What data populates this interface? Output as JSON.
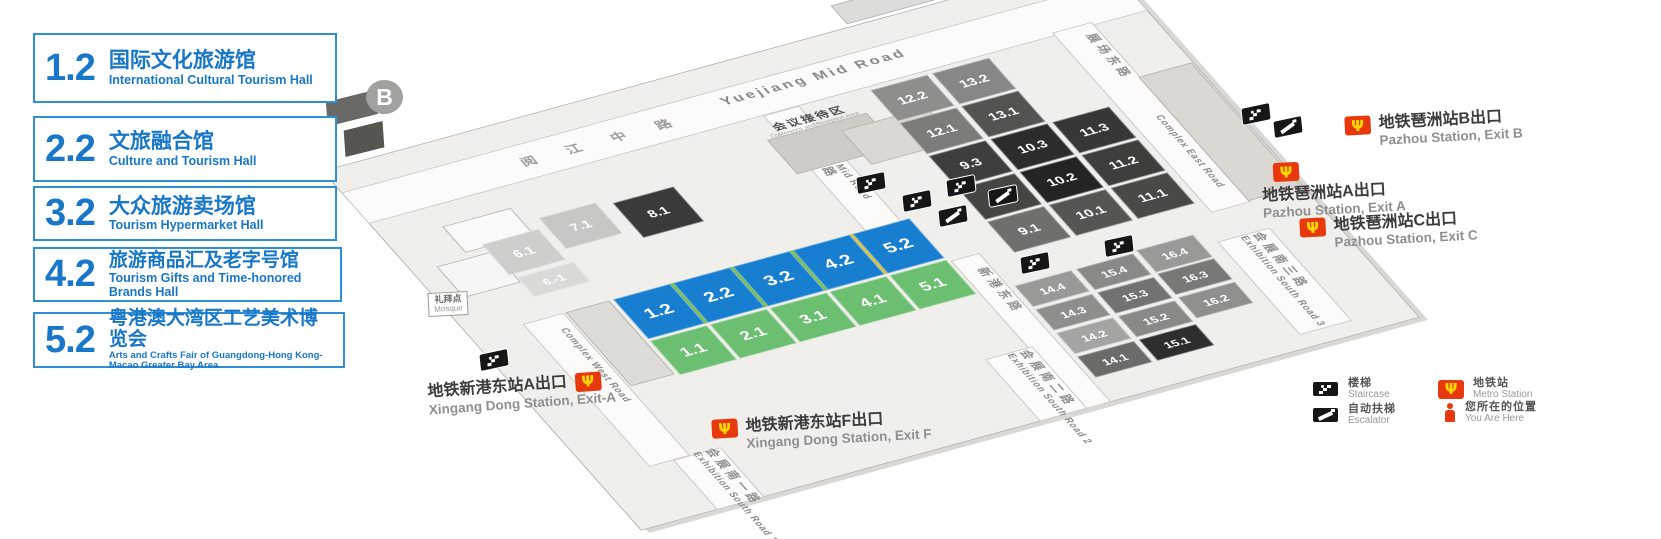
{
  "legend_panels": [
    {
      "code": "1.2",
      "title_zh": "国际文化旅游馆",
      "title_en": "International Cultural Tourism Hall"
    },
    {
      "code": "2.2",
      "title_zh": "文旅融合馆",
      "title_en": "Culture and Tourism Hall"
    },
    {
      "code": "3.2",
      "title_zh": "大众旅游卖场馆",
      "title_en": "Tourism Hypermarket Hall"
    },
    {
      "code": "4.2",
      "title_zh": "旅游商品汇及老字号馆",
      "title_en": "Tourism Gifts and Time-honored Brands Hall"
    },
    {
      "code": "5.2",
      "title_zh": "粤港澳大湾区工艺美术博览会",
      "title_en": "Arts and Crafts Fair of Guangdong-Hong Kong-Macao Greater Bay Area"
    }
  ],
  "map": {
    "area_marker": "B",
    "roads": {
      "yuejiang_en": "Yuejiang Mid Road",
      "yuejiang_zh": "阅 江 中 路",
      "complex_mid_en": "Complex Mid Road",
      "complex_mid_zh": "展场中路",
      "complex_east_en": "Complex East Road",
      "complex_east_zh": "展场东路",
      "complex_west_en": "Complex West Road",
      "xingang_zh": "新港东路",
      "south1_zh": "会展南一路",
      "south1_en": "Exhibition South Road 1",
      "south2_zh": "会展南二路",
      "south2_en": "Exhibition South Road 2",
      "south3_zh": "会展南三路",
      "south3_en": "Exhibition South Road 3"
    },
    "conference": {
      "zh": "会议接待区",
      "en": "Conference and Reception Area"
    },
    "mosque": {
      "zh": "礼拜点",
      "en": "Mosque"
    },
    "highlight_colors": {
      "blue": "#187fd0",
      "green": "#6cbe71",
      "divider_green": "#7ec24a",
      "divider_yellow": "#e2c53a"
    },
    "halls": [
      {
        "label": "1.2",
        "style": {
          "left": "150px",
          "top": "270px",
          "width": "60px",
          "height": "64px",
          "background": "#187fd0",
          "fontSize": "20px"
        }
      },
      {
        "label": "2.2",
        "style": {
          "left": "213px",
          "top": "270px",
          "width": "60px",
          "height": "64px",
          "background": "#187fd0",
          "fontSize": "20px"
        }
      },
      {
        "label": "3.2",
        "style": {
          "left": "276px",
          "top": "270px",
          "width": "60px",
          "height": "64px",
          "background": "#187fd0",
          "fontSize": "20px"
        }
      },
      {
        "label": "4.2",
        "style": {
          "left": "339px",
          "top": "270px",
          "width": "60px",
          "height": "64px",
          "background": "#187fd0",
          "fontSize": "20px"
        }
      },
      {
        "label": "5.2",
        "style": {
          "left": "402px",
          "top": "270px",
          "width": "60px",
          "height": "64px",
          "background": "#187fd0",
          "fontSize": "20px"
        }
      },
      {
        "label": "1.1",
        "style": {
          "left": "150px",
          "top": "337px",
          "width": "60px",
          "height": "55px",
          "background": "#6cbe71",
          "fontSize": "18px"
        }
      },
      {
        "label": "2.1",
        "style": {
          "left": "213px",
          "top": "337px",
          "width": "60px",
          "height": "55px",
          "background": "#6cbe71",
          "fontSize": "18px"
        }
      },
      {
        "label": "3.1",
        "style": {
          "left": "276px",
          "top": "337px",
          "width": "60px",
          "height": "55px",
          "background": "#6cbe71",
          "fontSize": "18px"
        }
      },
      {
        "label": "4.1",
        "style": {
          "left": "339px",
          "top": "337px",
          "width": "60px",
          "height": "55px",
          "background": "#6cbe71",
          "fontSize": "18px"
        }
      },
      {
        "label": "5.1",
        "style": {
          "left": "402px",
          "top": "337px",
          "width": "60px",
          "height": "55px",
          "background": "#6cbe71",
          "fontSize": "18px"
        }
      },
      {
        "label": "12.2",
        "style": {
          "left": "525px",
          "top": "90px",
          "width": "60px",
          "height": "50px",
          "background": "#908e8b"
        }
      },
      {
        "label": "13.2",
        "style": {
          "left": "590px",
          "top": "90px",
          "width": "60px",
          "height": "50px",
          "background": "#898785"
        }
      },
      {
        "label": "12.1",
        "style": {
          "left": "525px",
          "top": "143px",
          "width": "60px",
          "height": "50px",
          "background": "#7e7c79"
        }
      },
      {
        "label": "13.1",
        "style": {
          "left": "590px",
          "top": "143px",
          "width": "60px",
          "height": "50px",
          "background": "#555350"
        }
      },
      {
        "label": "9.3",
        "style": {
          "left": "525px",
          "top": "196px",
          "width": "60px",
          "height": "50px",
          "background": "#403e3c"
        }
      },
      {
        "label": "10.3",
        "style": {
          "left": "590px",
          "top": "196px",
          "width": "60px",
          "height": "50px",
          "background": "#2e2c2a"
        }
      },
      {
        "label": "11.3",
        "style": {
          "left": "655px",
          "top": "196px",
          "width": "60px",
          "height": "50px",
          "background": "#393735"
        }
      },
      {
        "label": "9.2",
        "style": {
          "left": "525px",
          "top": "249px",
          "width": "60px",
          "height": "50px",
          "background": "#474542"
        }
      },
      {
        "label": "10.2",
        "style": {
          "left": "590px",
          "top": "249px",
          "width": "60px",
          "height": "50px",
          "background": "#262422"
        }
      },
      {
        "label": "11.2",
        "style": {
          "left": "655px",
          "top": "249px",
          "width": "60px",
          "height": "50px",
          "background": "#403e3b"
        }
      },
      {
        "label": "9.1",
        "style": {
          "left": "525px",
          "top": "302px",
          "width": "60px",
          "height": "50px",
          "background": "#716f6c"
        }
      },
      {
        "label": "10.1",
        "style": {
          "left": "590px",
          "top": "302px",
          "width": "60px",
          "height": "50px",
          "background": "#575552"
        }
      },
      {
        "label": "11.1",
        "style": {
          "left": "655px",
          "top": "302px",
          "width": "60px",
          "height": "50px",
          "background": "#4b4946"
        }
      },
      {
        "label": "6.1",
        "style": {
          "left": "80px",
          "top": "152px",
          "width": "60px",
          "height": "50px",
          "background": "#d0cecb"
        }
      },
      {
        "label": "7.1",
        "style": {
          "left": "148px",
          "top": "138px",
          "width": "60px",
          "height": "50px",
          "background": "#c9c7c4"
        }
      },
      {
        "label": "8.1",
        "style": {
          "left": "222px",
          "top": "145px",
          "width": "64px",
          "height": "56px",
          "background": "#3b3a38"
        }
      },
      {
        "label": "6.-1",
        "style": {
          "left": "85px",
          "top": "207px",
          "width": "60px",
          "height": "32px",
          "background": "#dcdad7",
          "fontSize": "13px"
        }
      },
      {
        "label": "14.4",
        "style": {
          "left": "500px",
          "top": "395px",
          "width": "60px",
          "height": "34px",
          "background": "#9b9996",
          "fontSize": "13px"
        }
      },
      {
        "label": "15.4",
        "style": {
          "left": "565px",
          "top": "395px",
          "width": "60px",
          "height": "34px",
          "background": "#8b8986",
          "fontSize": "13px"
        }
      },
      {
        "label": "16.4",
        "style": {
          "left": "630px",
          "top": "392px",
          "width": "60px",
          "height": "36px",
          "background": "#9b9996",
          "fontSize": "13px"
        }
      },
      {
        "label": "14.3",
        "style": {
          "left": "500px",
          "top": "433px",
          "width": "60px",
          "height": "34px",
          "background": "#908e8b",
          "fontSize": "13px"
        }
      },
      {
        "label": "15.3",
        "style": {
          "left": "565px",
          "top": "433px",
          "width": "60px",
          "height": "34px",
          "background": "#747270",
          "fontSize": "13px"
        }
      },
      {
        "label": "16.3",
        "style": {
          "left": "630px",
          "top": "430px",
          "width": "60px",
          "height": "34px",
          "background": "#7a7875",
          "fontSize": "13px"
        }
      },
      {
        "label": "14.2",
        "style": {
          "left": "500px",
          "top": "471px",
          "width": "60px",
          "height": "34px",
          "background": "#a6a4a1",
          "fontSize": "13px"
        }
      },
      {
        "label": "15.2",
        "style": {
          "left": "565px",
          "top": "471px",
          "width": "60px",
          "height": "34px",
          "background": "#8b8986",
          "fontSize": "13px"
        }
      },
      {
        "label": "16.2",
        "style": {
          "left": "630px",
          "top": "468px",
          "width": "60px",
          "height": "34px",
          "background": "#918f8c",
          "fontSize": "13px"
        }
      },
      {
        "label": "14.1",
        "style": {
          "left": "500px",
          "top": "509px",
          "width": "60px",
          "height": "34px",
          "background": "#6d6b68",
          "fontSize": "13px"
        }
      },
      {
        "label": "15.1",
        "style": {
          "left": "565px",
          "top": "509px",
          "width": "60px",
          "height": "34px",
          "background": "#2f2e2c",
          "fontSize": "13px"
        }
      }
    ],
    "badges": [
      {
        "type": "staircase",
        "name": "staircase-icon",
        "style": {
          "left": "856px",
          "top": "174px"
        }
      },
      {
        "type": "staircase",
        "name": "staircase-icon",
        "style": {
          "left": "902px",
          "top": "192px"
        }
      },
      {
        "type": "staircase",
        "name": "staircase-icon",
        "style": {
          "left": "946px",
          "top": "177px"
        }
      },
      {
        "type": "staircase",
        "name": "staircase-icon",
        "style": {
          "left": "1020px",
          "top": "254px"
        }
      },
      {
        "type": "staircase",
        "name": "staircase-icon",
        "style": {
          "left": "1104px",
          "top": "237px"
        }
      },
      {
        "type": "staircase",
        "name": "staircase-icon",
        "style": {
          "left": "1241px",
          "top": "105px"
        }
      },
      {
        "type": "staircase",
        "name": "staircase-icon",
        "style": {
          "left": "479px",
          "top": "351px"
        }
      },
      {
        "type": "escalator",
        "name": "escalator-icon",
        "style": {
          "left": "988px",
          "top": "187px"
        }
      },
      {
        "type": "escalator",
        "name": "escalator-icon",
        "style": {
          "left": "938px",
          "top": "207px"
        }
      },
      {
        "type": "escalator",
        "name": "escalator-icon",
        "style": {
          "left": "1273px",
          "top": "118px"
        }
      }
    ]
  },
  "stations": {
    "pazhou_b": {
      "zh": "地铁琶洲站B出口",
      "en": "Pazhou Station, Exit B"
    },
    "pazhou_a": {
      "zh": "地铁琶洲站A出口",
      "en": "Pazhou Station, Exit A"
    },
    "pazhou_c": {
      "zh": "地铁琶洲站C出口",
      "en": "Pazhou Station, Exit C"
    },
    "xingang_a": {
      "zh": "地铁新港东站A出口",
      "en": "Xingang Dong Station, Exit-A"
    },
    "xingang_f": {
      "zh": "地铁新港东站F出口",
      "en": "Xingang Dong Station, Exit F"
    }
  },
  "map_legend": {
    "items": [
      {
        "icon": "staircase",
        "zh": "楼梯",
        "en": "Staircase"
      },
      {
        "icon": "escalator",
        "zh": "自动扶梯",
        "en": "Escalator"
      },
      {
        "icon": "metro",
        "zh": "地铁站",
        "en": "Metro Station"
      },
      {
        "icon": "you-are-here",
        "zh": "您所在的位置",
        "en": "You Are Here"
      }
    ]
  },
  "icons": {
    "metro_glyph": "Ψ"
  }
}
